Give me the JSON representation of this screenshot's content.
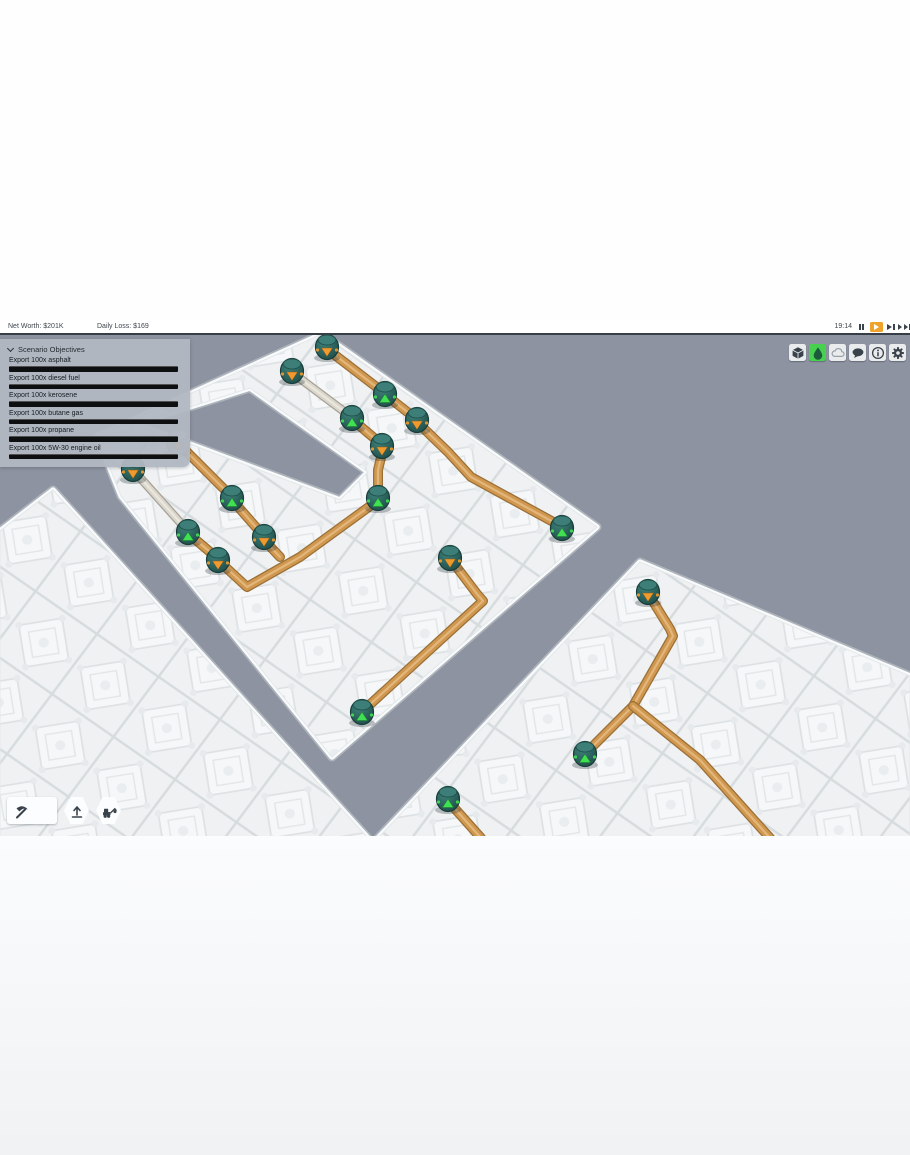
{
  "hud": {
    "net_worth": "Net Worth: $201K",
    "daily_loss": "Daily Loss: $169",
    "time": "19:14",
    "playback": [
      {
        "name": "pause-button",
        "icon": "pause-icon",
        "active": false
      },
      {
        "name": "play-button",
        "icon": "play-icon",
        "active": true
      },
      {
        "name": "fast-forward-button",
        "icon": "fast-forward-icon",
        "active": false
      },
      {
        "name": "fastest-forward-button",
        "icon": "fastest-forward-icon",
        "active": false
      }
    ]
  },
  "objectives": {
    "title": "Scenario Objectives",
    "items": [
      {
        "label": "Export 100x asphalt",
        "progress": 0
      },
      {
        "label": "Export 100x diesel fuel",
        "progress": 0
      },
      {
        "label": "Export 100x kerosene",
        "progress": 0
      },
      {
        "label": "Export 100x butane gas",
        "progress": 0
      },
      {
        "label": "Export 100x propane",
        "progress": 0
      },
      {
        "label": "Export 100x 5W-30 engine oil",
        "progress": 0
      }
    ]
  },
  "top_right_buttons": [
    {
      "name": "resources-button",
      "icon": "cube-icon",
      "active": false,
      "disabled": false
    },
    {
      "name": "fluids-button",
      "icon": "droplet-icon",
      "active": true,
      "disabled": false
    },
    {
      "name": "weather-button",
      "icon": "cloud-icon",
      "active": false,
      "disabled": true
    },
    {
      "name": "messages-button",
      "icon": "speech-bubble-icon",
      "active": false,
      "disabled": false
    },
    {
      "name": "info-button",
      "icon": "info-icon",
      "active": false,
      "disabled": false
    },
    {
      "name": "settings-button",
      "icon": "gear-icon",
      "active": false,
      "disabled": false
    }
  ],
  "toolbar": [
    {
      "name": "build-tool-button",
      "icon": "pickaxe-icon",
      "shape": "wide"
    },
    {
      "name": "export-tool-button",
      "icon": "export-arrow-icon",
      "shape": "hex"
    },
    {
      "name": "demolish-tool-button",
      "icon": "excavator-icon",
      "shape": "hex"
    }
  ],
  "colors": {
    "background": "#8d93a0",
    "platform": "#eff1f3",
    "platform_line": "#d6dbdd",
    "platform_ornament": "#e2e6e8",
    "edge_light": "#f8fafb",
    "edge_dark": "#b2b8be",
    "pipe": "#d0974f",
    "pipe_dark": "#9a6f35",
    "pipe_highlight": "#e9c08b",
    "pipe_empty": "#dad6cc",
    "pipe_empty_dark": "#a8a296",
    "pump_body": "#2d6a64",
    "pump_body_dark": "#1f4b47",
    "pump_cap": "#3d7f78",
    "pump_gray": "#a3b2b0",
    "marker_orange": "#f09a2e",
    "marker_green": "#41e053",
    "accent_play": "#f0a32a",
    "accent_green": "#47d14f",
    "icon_dark": "#39424a"
  },
  "scene": {
    "platforms": [
      {
        "name": "main-u-platform",
        "rings": [
          [
            [
              322,
              334
            ],
            [
              597,
              527
            ],
            [
              332,
              757
            ],
            [
              121,
              496
            ],
            [
              97,
              436
            ]
          ],
          [
            [
              250,
              388
            ],
            [
              368,
              472
            ],
            [
              340,
              500
            ],
            [
              136,
              424
            ]
          ]
        ]
      },
      {
        "name": "bottom-left-platform",
        "rings": [
          [
            [
              53,
              490
            ],
            [
              368,
              838
            ],
            [
              0,
              838
            ],
            [
              0,
              531
            ]
          ]
        ]
      },
      {
        "name": "right-platform",
        "rings": [
          [
            [
              640,
              562
            ],
            [
              910,
              676
            ],
            [
              910,
              838
            ],
            [
              378,
              838
            ]
          ]
        ]
      }
    ],
    "pipes": [
      {
        "pts": [
          [
            327,
            349
          ],
          [
            383,
            392
          ]
        ],
        "type": "oil"
      },
      {
        "pts": [
          [
            387,
            396
          ],
          [
            415,
            418
          ]
        ],
        "type": "oil"
      },
      {
        "pts": [
          [
            294,
            374
          ],
          [
            350,
            416
          ]
        ],
        "type": "empty"
      },
      {
        "pts": [
          [
            354,
            421
          ],
          [
            380,
            443
          ]
        ],
        "type": "oil"
      },
      {
        "pts": [
          [
            135,
            472
          ],
          [
            186,
            529
          ]
        ],
        "type": "empty"
      },
      {
        "pts": [
          [
            180,
            445
          ],
          [
            230,
            495
          ]
        ],
        "type": "oil"
      },
      {
        "pts": [
          [
            190,
            535
          ],
          [
            216,
            557
          ]
        ],
        "type": "oil"
      },
      {
        "pts": [
          [
            233,
            501
          ],
          [
            262,
            534
          ]
        ],
        "type": "oil"
      },
      {
        "pts": [
          [
            417,
            422
          ],
          [
            448,
            452
          ],
          [
            471,
            477
          ],
          [
            557,
            524
          ]
        ],
        "type": "oil"
      },
      {
        "pts": [
          [
            383,
            449
          ],
          [
            378,
            470
          ],
          [
            378,
            495
          ]
        ],
        "type": "oil"
      },
      {
        "pts": [
          [
            377,
            501
          ],
          [
            300,
            557
          ],
          [
            247,
            587
          ],
          [
            221,
            563
          ]
        ],
        "type": "oil"
      },
      {
        "pts": [
          [
            264,
            540
          ],
          [
            280,
            557
          ]
        ],
        "type": "oil"
      },
      {
        "pts": [
          [
            452,
            561
          ],
          [
            477,
            594
          ],
          [
            483,
            601
          ],
          [
            365,
            709
          ]
        ],
        "type": "oil"
      },
      {
        "pts": [
          [
            649,
            595
          ],
          [
            670,
            629
          ],
          [
            673,
            636
          ],
          [
            633,
            706
          ],
          [
            588,
            751
          ]
        ],
        "type": "oil"
      },
      {
        "pts": [
          [
            633,
            706
          ],
          [
            700,
            760
          ],
          [
            770,
            838
          ]
        ],
        "type": "oil"
      },
      {
        "pts": [
          [
            449,
            802
          ],
          [
            481,
            838
          ]
        ],
        "type": "oil"
      }
    ],
    "pumps": [
      {
        "x": 327,
        "y": 347,
        "marker": "orange"
      },
      {
        "x": 292,
        "y": 371,
        "marker": "orange"
      },
      {
        "x": 385,
        "y": 394,
        "marker": "green"
      },
      {
        "x": 352,
        "y": 418,
        "marker": "green"
      },
      {
        "x": 417,
        "y": 420,
        "marker": "orange"
      },
      {
        "x": 382,
        "y": 446,
        "marker": "orange"
      },
      {
        "x": 178,
        "y": 442,
        "marker": "orange",
        "variant": "gray"
      },
      {
        "x": 133,
        "y": 469,
        "marker": "orange"
      },
      {
        "x": 232,
        "y": 498,
        "marker": "green"
      },
      {
        "x": 188,
        "y": 532,
        "marker": "green"
      },
      {
        "x": 218,
        "y": 560,
        "marker": "orange"
      },
      {
        "x": 264,
        "y": 537,
        "marker": "orange"
      },
      {
        "x": 378,
        "y": 498,
        "marker": "green"
      },
      {
        "x": 450,
        "y": 558,
        "marker": "orange"
      },
      {
        "x": 562,
        "y": 528,
        "marker": "green"
      },
      {
        "x": 362,
        "y": 712,
        "marker": "green"
      },
      {
        "x": 648,
        "y": 592,
        "marker": "orange"
      },
      {
        "x": 585,
        "y": 754,
        "marker": "green"
      },
      {
        "x": 448,
        "y": 799,
        "marker": "green"
      }
    ]
  }
}
